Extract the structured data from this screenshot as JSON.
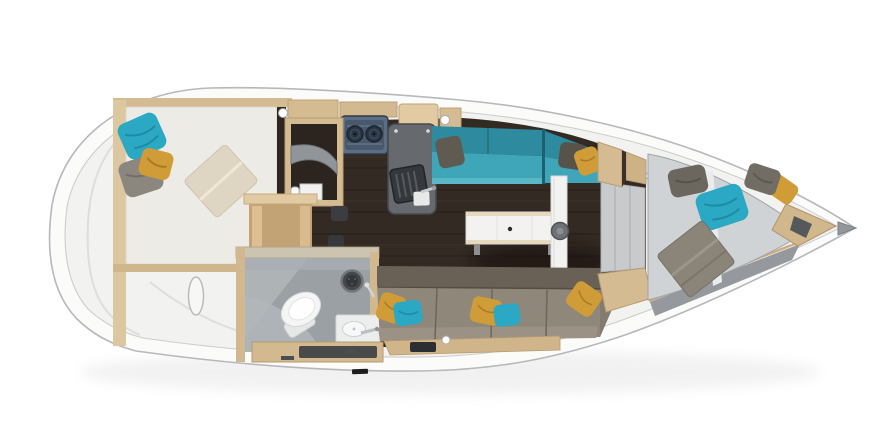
{
  "scene": {
    "kind": "sailboat-interior-floorplan-top-view",
    "orientation": "stern-left-bow-right",
    "background": "#ffffff"
  },
  "palette": {
    "hull_fill": "#fbfbfa",
    "deck_fill": "#f2f2f0",
    "hull_line": "#b6b8bb",
    "deck_line": "#cbcdcf",
    "wood_beige": "#d5bb92",
    "wood_beige_dark": "#c2a376",
    "wood_beige_light": "#e2cba2",
    "floor_espresso": "#332a23",
    "teal_back": "#2e8a9e",
    "teal_seat": "#3fa6b9",
    "teal_front": "#5ab7c6",
    "teal_pillow": "#2ba8c3",
    "mustard_pillow": "#d09c38",
    "gray_pillow_light": "#8b867e",
    "gray_pillow_mid": "#6b675f",
    "gray_pillow_dark": "#5f5b50",
    "taupe_seat": "#8f8779",
    "taupe_back": "#6a6156",
    "taupe_roll": "#9b9285",
    "mattress_white": "#edebe5",
    "mattress_gray": "#d0d3d5",
    "blanket_cream": "#ded6c2",
    "blanket_gray": "#8b8478",
    "head_floor": "#9aa0a3",
    "head_wall_light": "#aeb4b6",
    "counter_gray": "#666a6e",
    "sink_rack": "#34383c",
    "stove_base": "#5b6e83",
    "stove_panel": "#49596c",
    "fixture_white": "#f3f2f0",
    "door_gray": "#c8cacc",
    "band_gray": "#95999d",
    "tip_gray": "#93979b"
  },
  "regions": {
    "aft_cabin": {
      "name": "aft double berth",
      "pillows": [
        "teal",
        "gray",
        "mustard"
      ],
      "blanket": "cream"
    },
    "stern_locker": {
      "name": "transom storage with oval hatch handle"
    },
    "companionway": {
      "name": "companionway steps"
    },
    "galley": {
      "name": "galley with two-burner stove and sink"
    },
    "saloon": {
      "name": "saloon with teal settee, taupe settee, white table, mast post"
    },
    "head": {
      "name": "head with toilet, shower, vanity sink"
    },
    "v_berth": {
      "name": "bow V-berth",
      "pillows": [
        "gray",
        "teal",
        "gray",
        "mustard"
      ],
      "blanket": "gray"
    }
  }
}
